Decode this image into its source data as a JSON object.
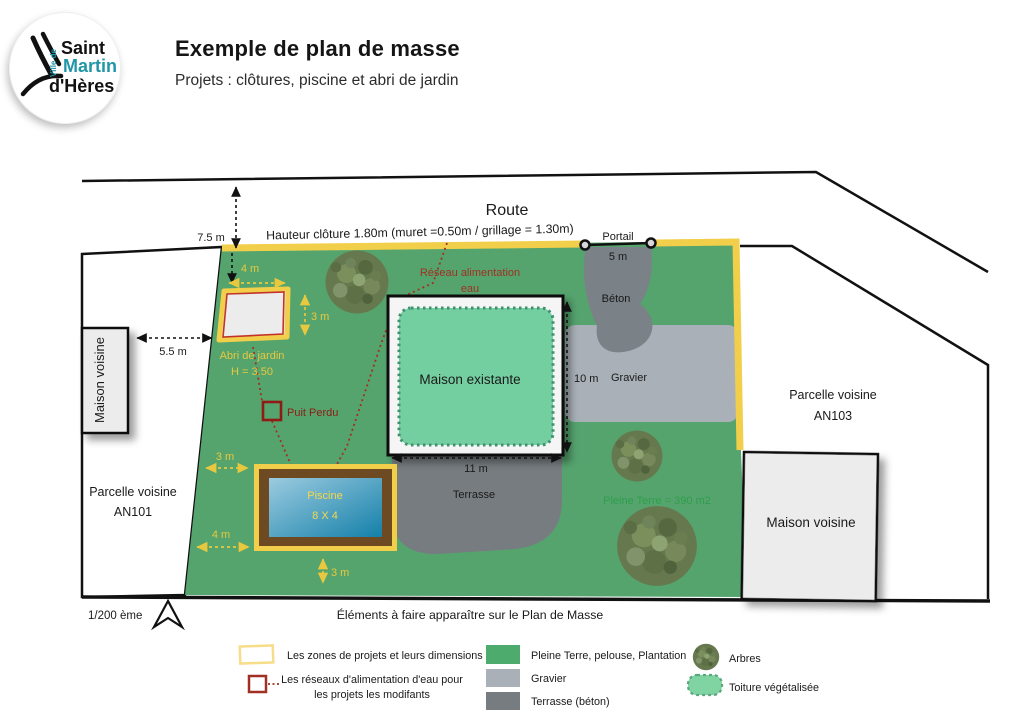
{
  "header": {
    "logo": {
      "ville_de": "Ville de",
      "line1": "Saint",
      "line2": "Martin",
      "line3": "d'Hères"
    },
    "title": "Exemple de plan de masse",
    "subtitle": "Projets : clôtures, piscine et abri de jardin"
  },
  "plan": {
    "route": "Route",
    "fence": "Hauteur clôture 1.80m (muret =0.50m / grillage = 1.30m)",
    "portail": "Portail",
    "dims": {
      "portail": "5 m",
      "road_setback": "7.5 m",
      "abri_width": "4 m",
      "abri_depth": "3 m",
      "abri_to_neighbor": "5.5 m",
      "house_depth": "10 m",
      "house_width": "11 m",
      "pool_left_top": "3 m",
      "pool_left_bottom": "4 m",
      "pool_bottom": "3 m"
    },
    "labels": {
      "maison_voisine_left": "Maison voisine",
      "maison_voisine_right": "Maison voisine",
      "maison_existante": "Maison existante",
      "abri_line1": "Abri de jardin",
      "abri_line2": "H = 3.50",
      "puit": "Puit Perdu",
      "reseau_line1": "Réseau alimentation",
      "reseau_line2": "eau",
      "piscine_line1": "Piscine",
      "piscine_line2": "8 X 4",
      "beton": "Béton",
      "gravier": "Gravier",
      "terrasse": "Terrasse",
      "pleine_terre": "Pleine Terre = 390 m2",
      "parcelle_left_line1": "Parcelle voisine",
      "parcelle_left_line2": "AN101",
      "parcelle_right_line1": "Parcelle voisine",
      "parcelle_right_line2": "AN103"
    },
    "scale": "1/200 ème",
    "caption": "Éléments à faire apparaître sur le Plan de Masse"
  },
  "legend": {
    "zones": "Les zones de projets et leurs dimensions",
    "reseaux_line1": "Les réseaux d'alimentation d'eau pour",
    "reseaux_line2": "les projets les modifants",
    "pleine_terre": "Pleine Terre, pelouse, Plantation",
    "gravier": "Gravier",
    "terrasse": "Terrasse (béton)",
    "arbres": "Arbres",
    "toiture": "Toiture végétalisée"
  },
  "colors": {
    "parcel_green": "#55a46e",
    "fence_yellow": "#f2cf4a",
    "dim_yellow": "#e8c83e",
    "water_red": "#a03022",
    "soakaway_red": "#8e1c15",
    "beton_gray": "#7a8187",
    "gravier_gray": "#a9b0b7",
    "terrasse_gray": "#767c80",
    "roof_green": "#74cfa0",
    "toiture_green": "#7fd4a2",
    "pleine_terre_text": "#2f9e4b",
    "pool_brown": "#6e4a22",
    "logo_teal": "#2196a8"
  }
}
